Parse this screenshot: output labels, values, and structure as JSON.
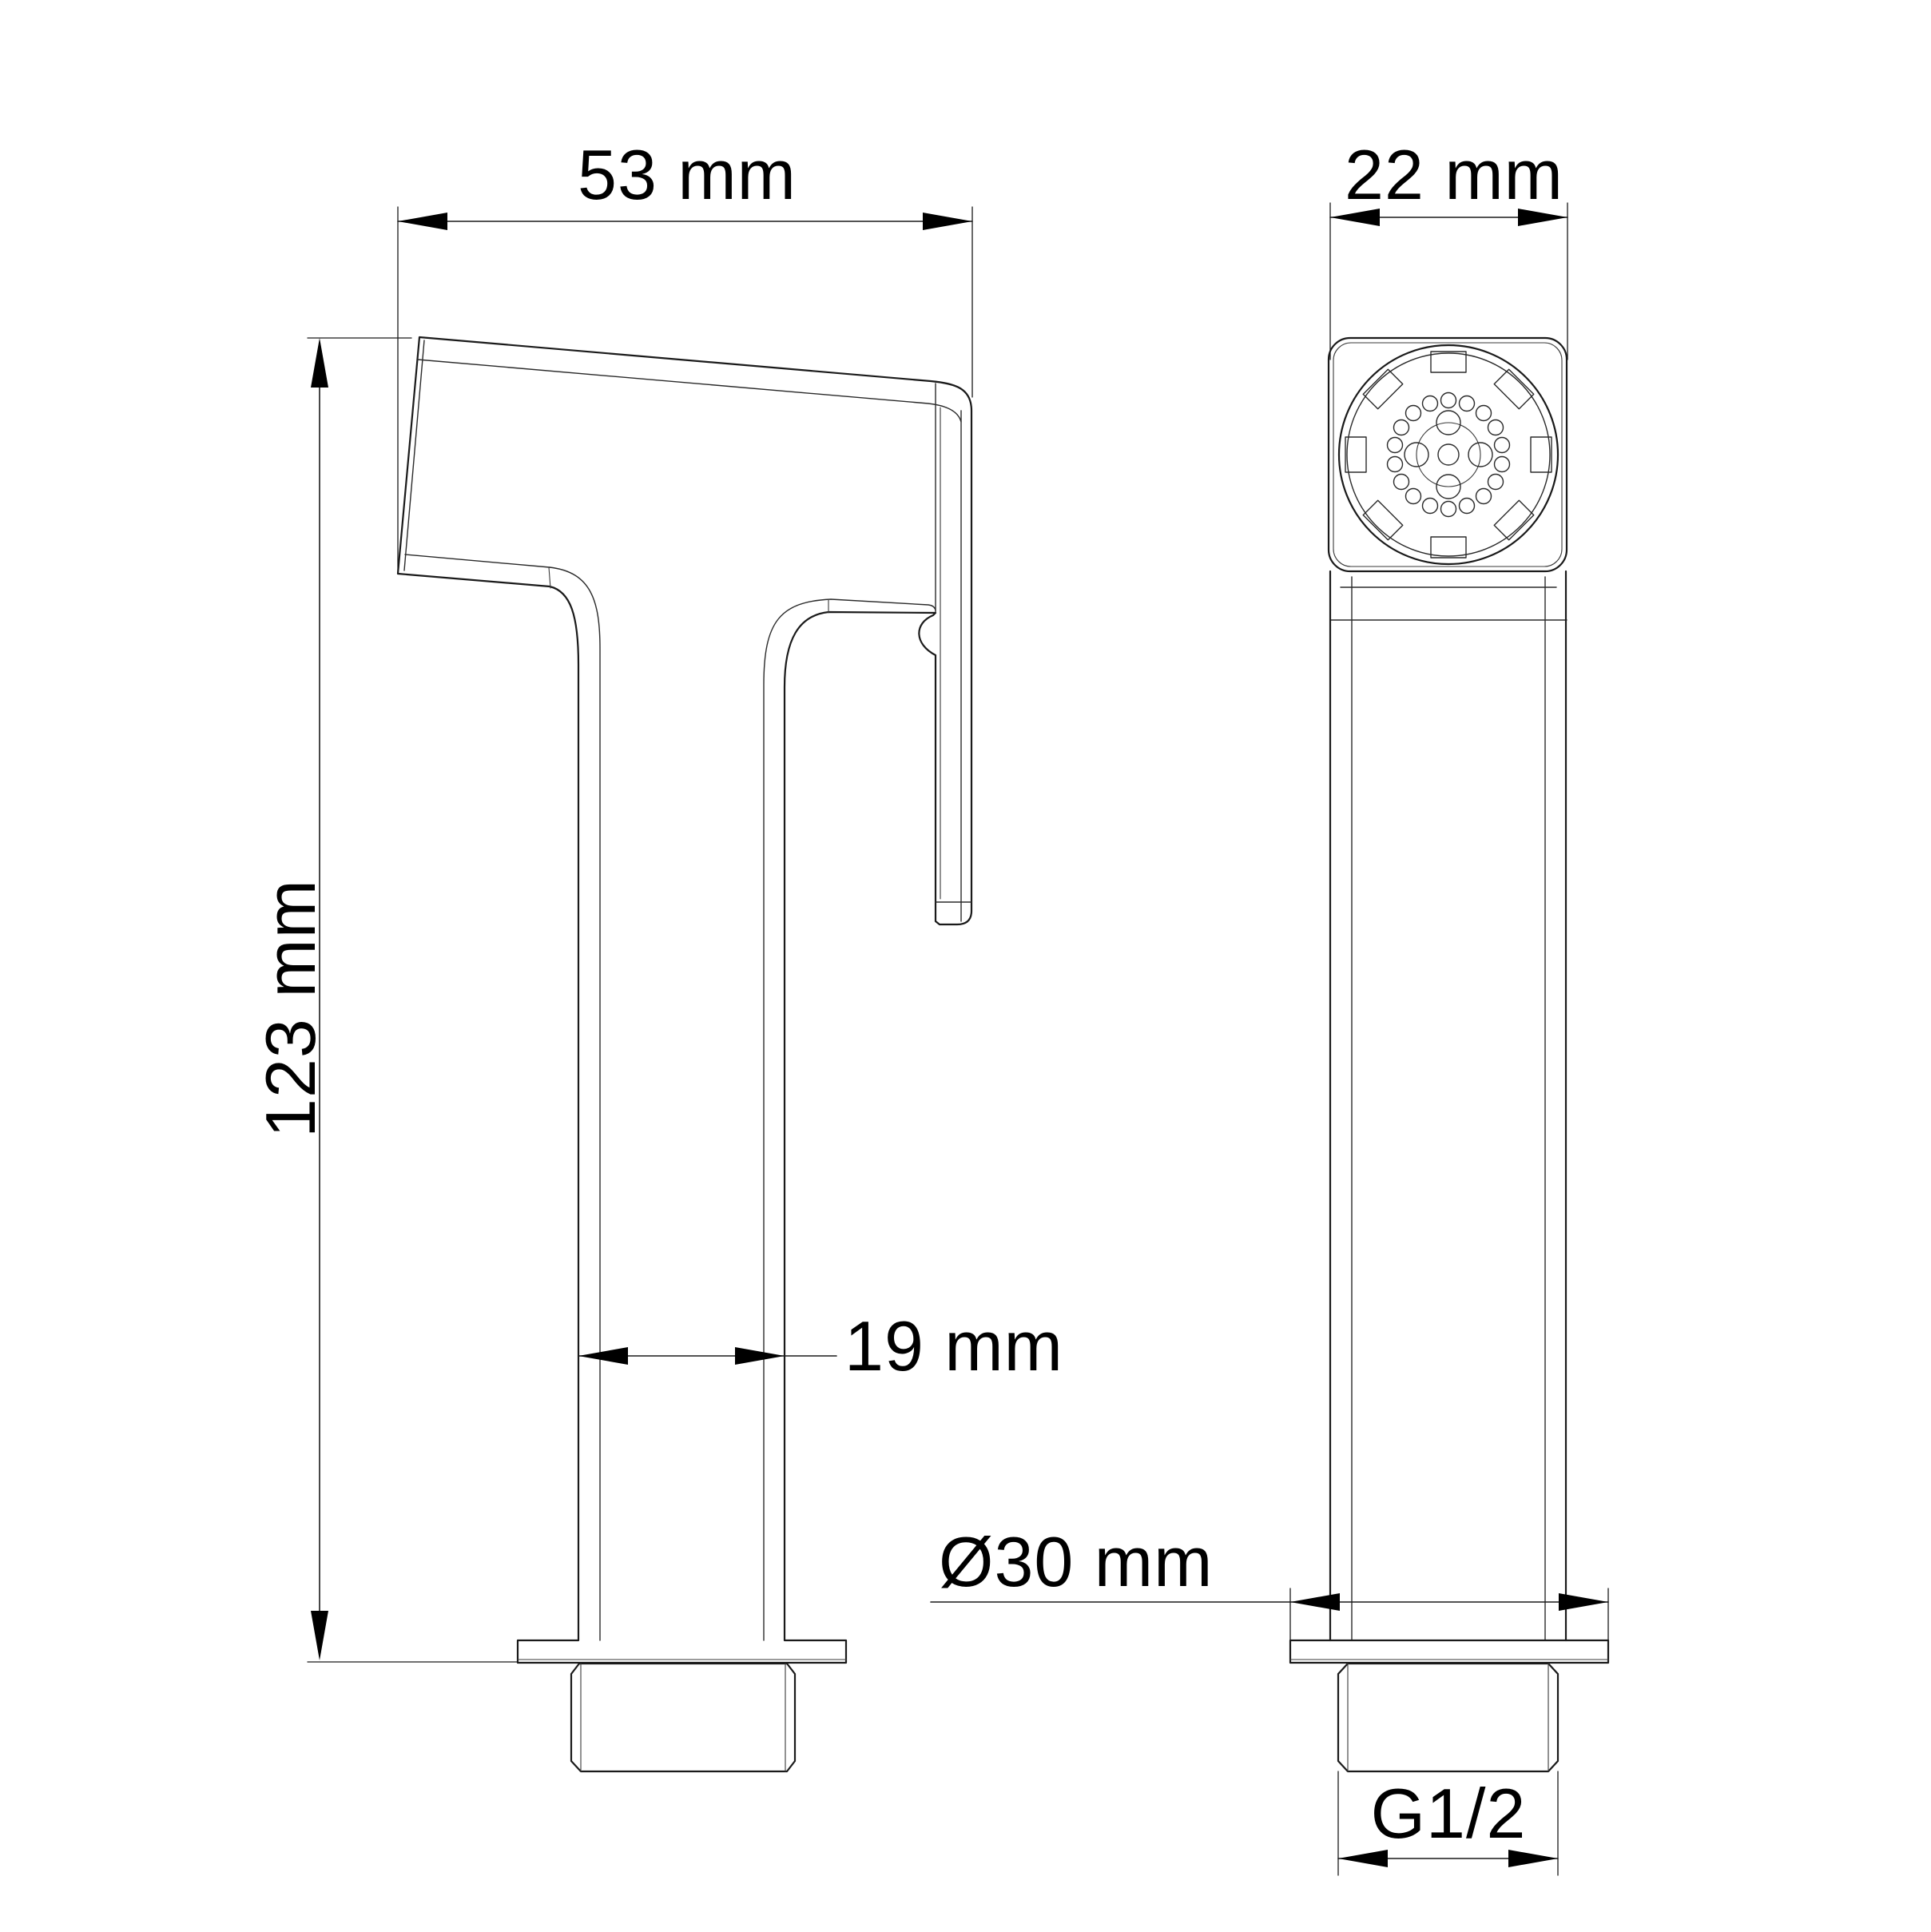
{
  "drawing": {
    "type": "technical-dimension-drawing",
    "subject": "hygienic hand shower (bidet sprayer), two orthographic views",
    "background_color": "#ffffff",
    "line_color": "#1a1a1a",
    "views": {
      "side_view": {
        "name": "side view",
        "features": [
          "tilted spray head",
          "spray face plate",
          "handle",
          "mounting flange",
          "threaded connector"
        ]
      },
      "front_view": {
        "name": "front view",
        "features": [
          "square head with rounded corners",
          "circular spray face",
          "8 grip notches",
          "nozzle ring of 18 holes",
          "4 inner nozzles",
          "center nozzle",
          "handle",
          "mounting flange",
          "threaded connector"
        ]
      }
    },
    "dimensions": {
      "head_length": "53 mm",
      "head_width": "22 mm",
      "total_height": "123 mm",
      "handle_depth": "19 mm",
      "flange_diameter": "Ø30 mm",
      "thread_size": "G1/2"
    }
  }
}
